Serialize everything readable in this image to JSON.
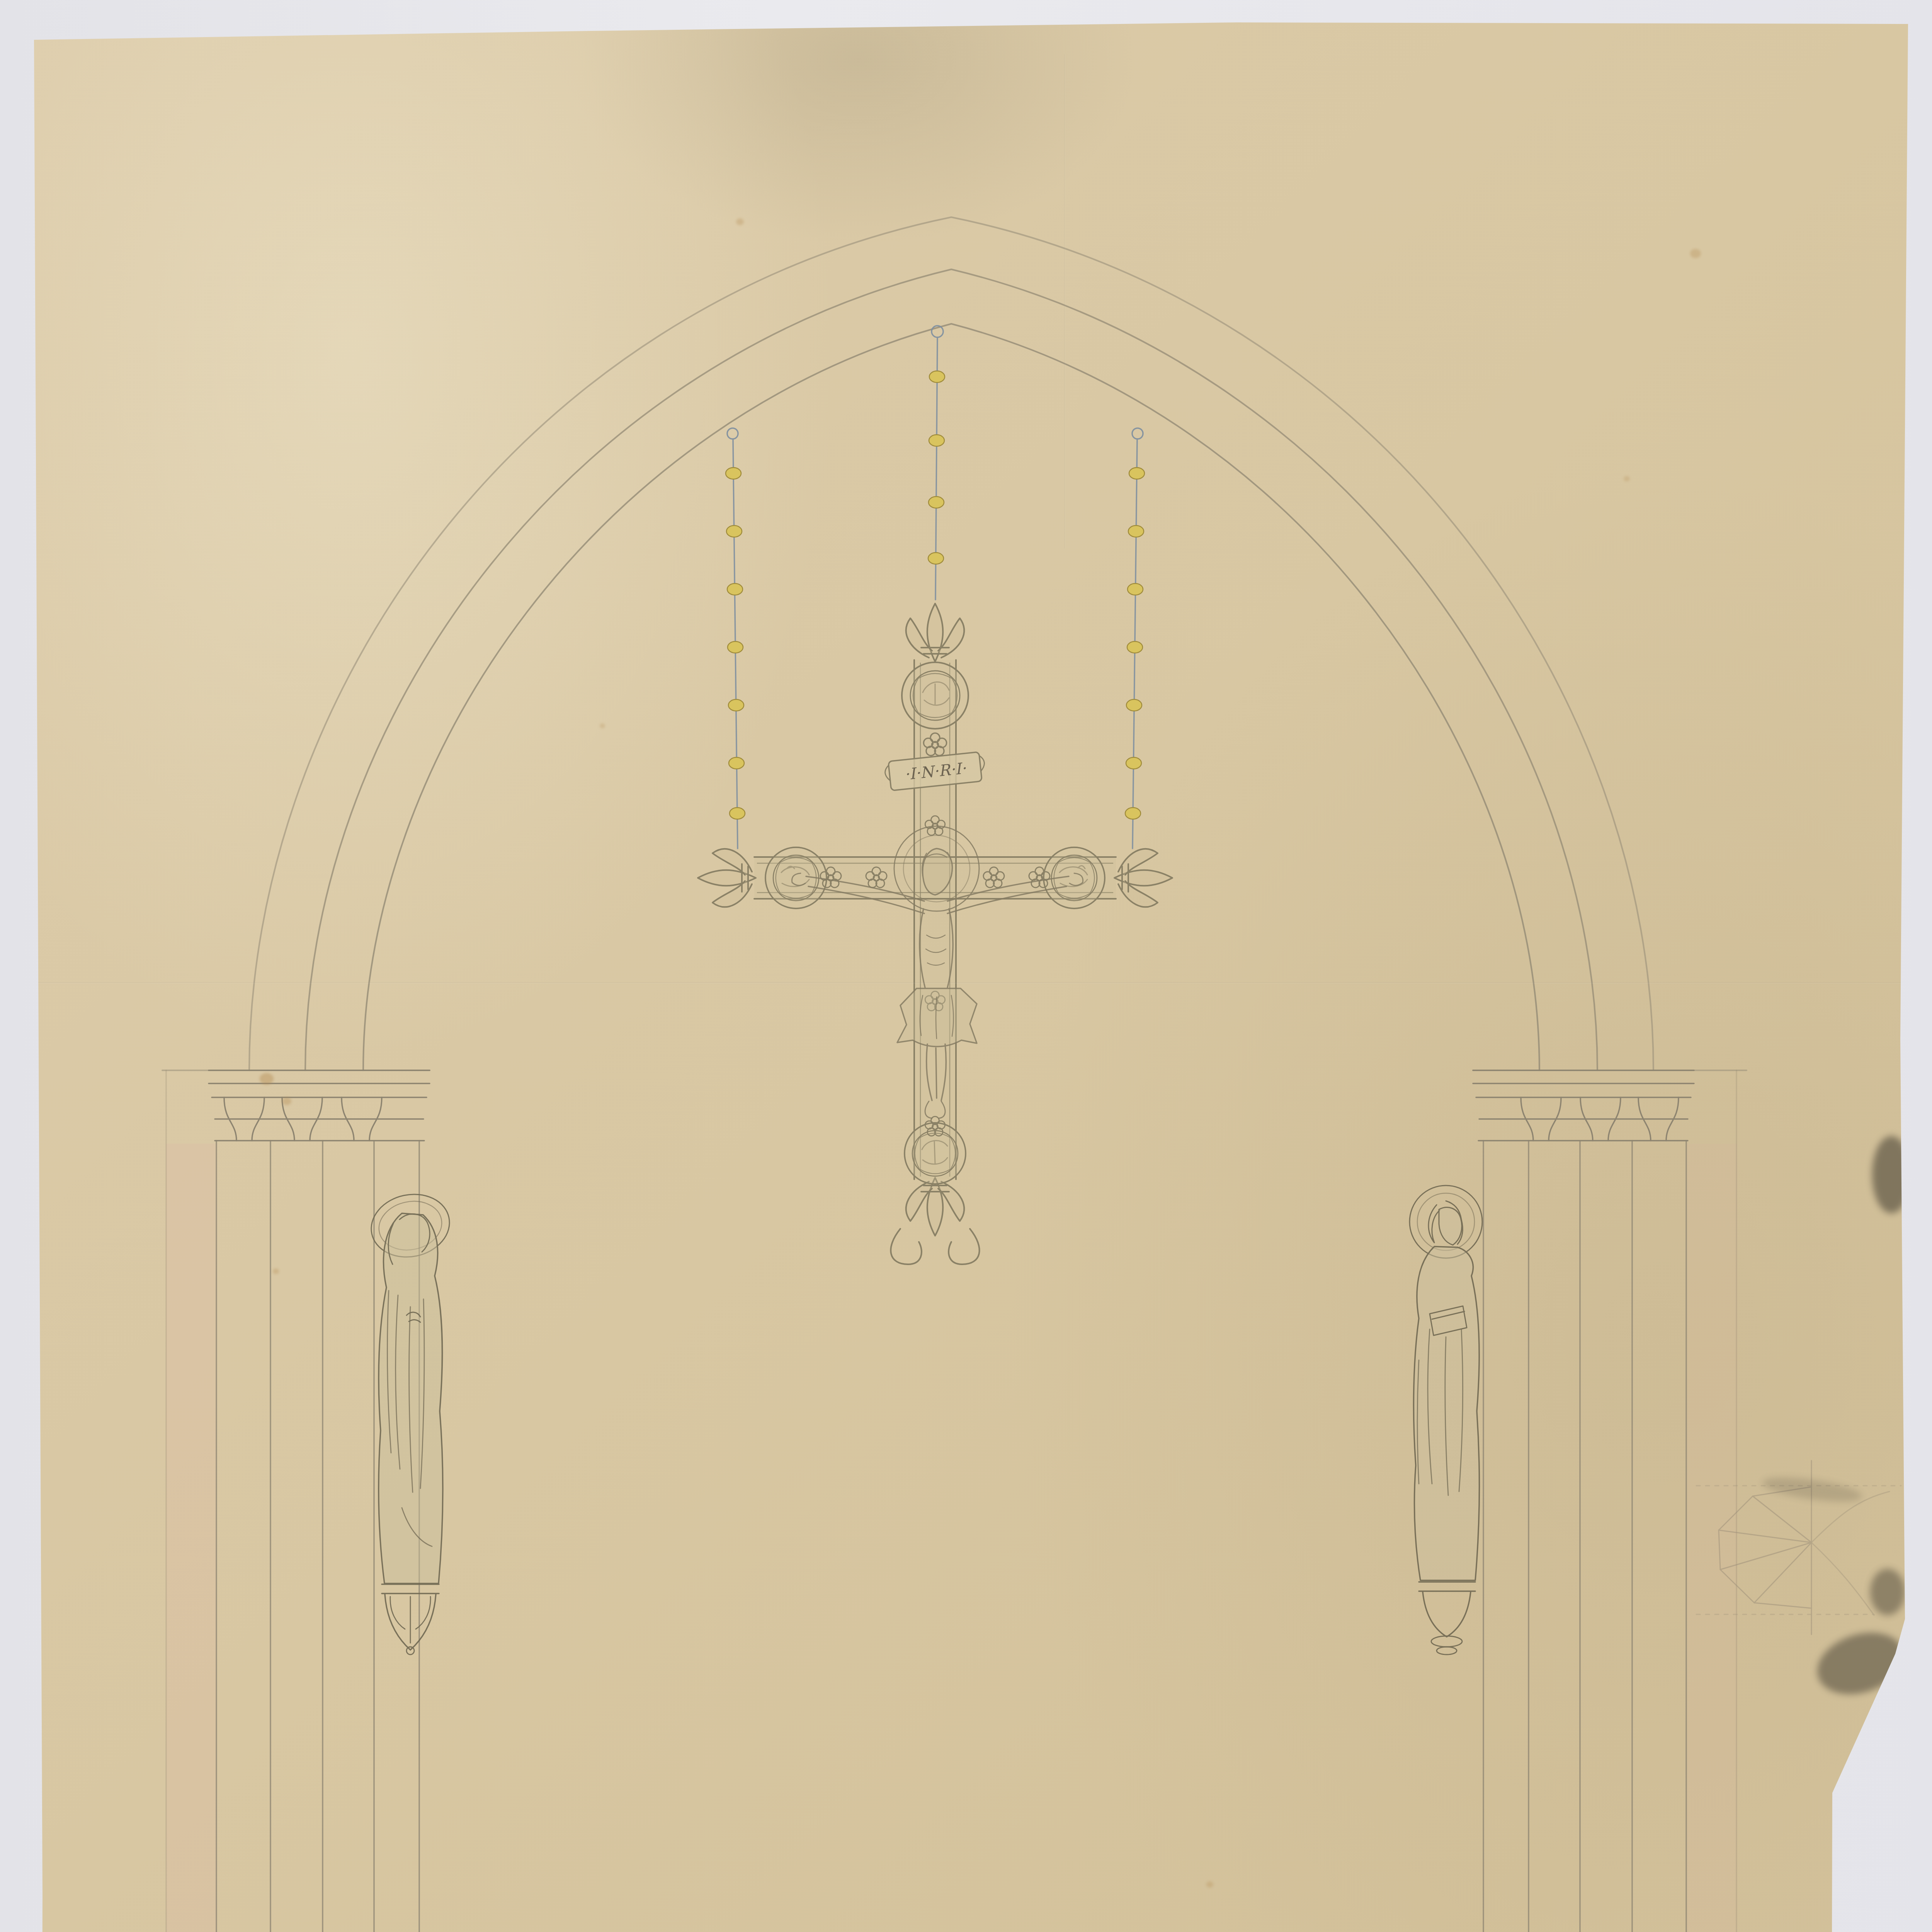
{
  "archival_number": "262",
  "titulus": "\u00b7I\u00b7N\u00b7R\u00b7I\u00b7",
  "cartouche": {
    "line1": "Ontwerp voor een hangend Kruis voor onder den Triomf-boog",
    "line2": "in de Parochiale Kerk van Assche; Sch. 5 per honderd. 18 \u2020 94."
  },
  "stamps": {
    "justice": {
      "line1": "VU PAR NOUS, MINISTRE DE LA JUSTICE",
      "line2": "Pour \u00eatre annex\u00e9 \u00e0 l\u2019arr\u00eat\u00e9 royal",
      "date_prefix": "du",
      "date_value": "12 juillet 1895, N\u00b0 4378 .",
      "signature": "Begerem"
    },
    "commission": {
      "line1": "Vu en s\u00e9ance de la Commission Royale",
      "line2_label": "des Monuments, le",
      "line2_value": "24 Novembre 1894.",
      "line3_label": "voir notre rapport du",
      "line3_value": "1er D\u00e9cembre, N\u00b0 3715.",
      "secretary_label": "Le Secr\u00e9taire",
      "president_label": "Le Pr\u00e9sident,",
      "secretary_signature": "A. Massaux"
    }
  },
  "approvals": {
    "communal": {
      "line1": "Vu et approuv\u00e9 par le Conseil Communal",
      "line2": "d\u2019Assche, en s\u00e9ance du 7 F\u00e9vrier 1895",
      "par_ordonnance": "Par ordonnance:",
      "bourgmestre_label": "Le Bourgmestre,",
      "secretaire_label": "Le Secr\u00e9taire,",
      "secretaire_signature": "J. Verbrugghen"
    },
    "fabrique": {
      "line1": "Vu et approuv\u00e9 par le Conseil de fabrique de l\u2019\u00c9glise Saint Martin",
      "line2": "d\u2019Assche, en s\u00e9ance du 6 Janvier 1895",
      "secretaire_label": "Le Secr\u00e9taire,",
      "president_label": "Le Pr\u00e9sident",
      "secretaire_signature": "Verbrugghen",
      "president_signature": "S. Van Innis"
    }
  }
}
